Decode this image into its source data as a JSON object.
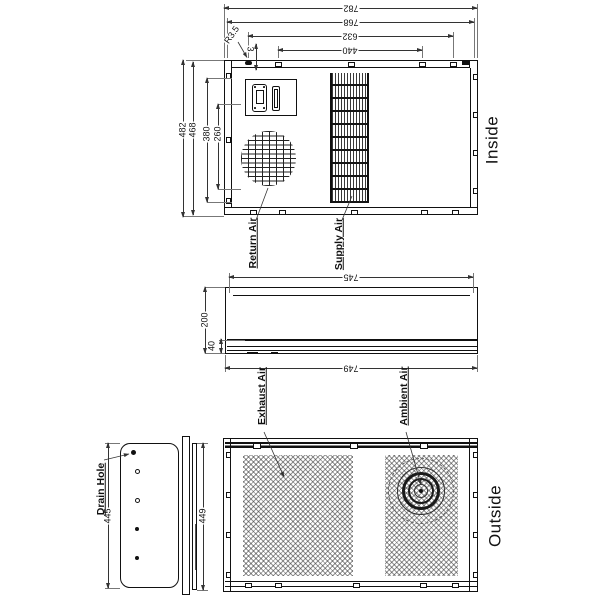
{
  "top_view": {
    "side_label": "Inside",
    "dims": {
      "d782": "782",
      "d768": "768",
      "d632": "632",
      "d440": "440",
      "r35": "R3.5",
      "d3": "3",
      "d482": "482",
      "d468": "468",
      "d380": "380",
      "d260": "260"
    },
    "labels": {
      "return_air": "Return Air",
      "supply_air": "Supply Air"
    }
  },
  "side_view": {
    "dims": {
      "d745": "745",
      "d749": "749",
      "d200": "200",
      "d40": "40"
    }
  },
  "left_view": {
    "dims": {
      "d445": "445",
      "d449": "449"
    },
    "labels": {
      "drain_hole": "Drain Hole"
    }
  },
  "outside_view": {
    "side_label": "Outside",
    "labels": {
      "exhaust_air": "Exhaust Air",
      "ambient_air": "Ambient Air"
    }
  },
  "colors": {
    "line": "#222222",
    "background": "#ffffff",
    "mesh": "#555555"
  }
}
